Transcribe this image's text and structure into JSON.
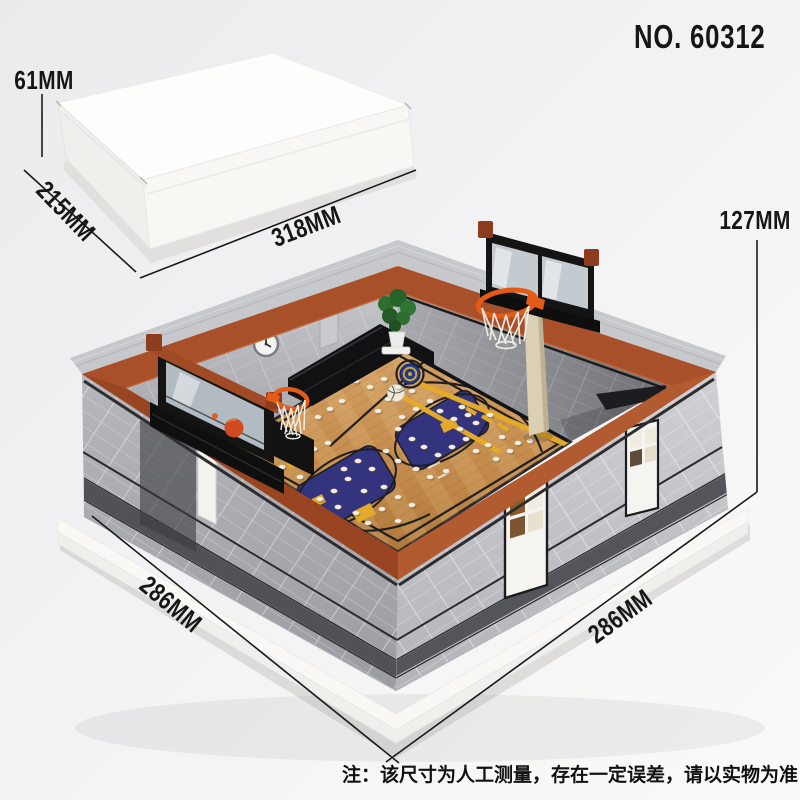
{
  "product": {
    "number": "NO. 60312"
  },
  "packaging_box": {
    "height": "61MM",
    "depth": "215MM",
    "width": "318MM"
  },
  "model": {
    "height": "127MM",
    "front_left_edge": "286MM",
    "front_right_edge": "286MM"
  },
  "footer_note": "注：该尺寸为人工测量，存在一定误差，请以实物为准！",
  "colors": {
    "coping_rust": "#a8502a",
    "wall_gray": "#b6b7bc",
    "court_wood": "#c59055",
    "key_navy": "#34347e",
    "accent_yellow": "#e2aa28",
    "rim_orange": "#e45a17",
    "scoreboard_black": "#141415",
    "platform_white": "#f9f8f5"
  }
}
